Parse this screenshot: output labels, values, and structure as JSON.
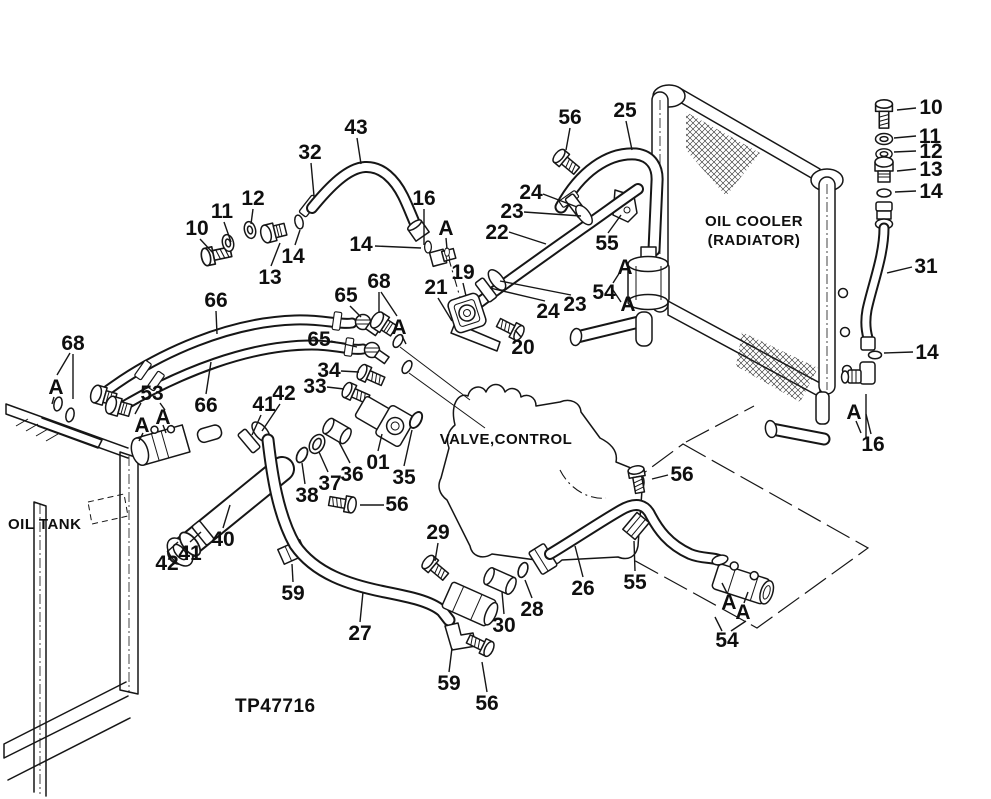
{
  "figure": {
    "drawing_number": "TP47716",
    "oil_cooler_label_line1": "OIL COOLER",
    "oil_cooler_label_line2": "(RADIATOR)",
    "valve_control_label": "VALVE,CONTROL",
    "oil_tank_label": "OIL TANK"
  },
  "callouts": [
    {
      "text": "10",
      "x": 197,
      "y": 228,
      "l": [
        200,
        239,
        213,
        253
      ]
    },
    {
      "text": "11",
      "x": 222,
      "y": 211,
      "l": [
        224,
        222,
        231,
        242
      ]
    },
    {
      "text": "12",
      "x": 253,
      "y": 198,
      "l": [
        253,
        209,
        251,
        224
      ]
    },
    {
      "text": "13",
      "x": 270,
      "y": 277,
      "l": [
        271,
        266,
        280,
        243
      ]
    },
    {
      "text": "14",
      "x": 293,
      "y": 256,
      "l": [
        295,
        245,
        300,
        230
      ]
    },
    {
      "text": "32",
      "x": 310,
      "y": 152,
      "l": [
        311,
        163,
        314,
        196
      ]
    },
    {
      "text": "43",
      "x": 356,
      "y": 127,
      "l": [
        357,
        138,
        361,
        164
      ]
    },
    {
      "text": "14",
      "x": 361,
      "y": 244,
      "l": [
        375,
        246,
        421,
        248
      ]
    },
    {
      "text": "16",
      "x": 424,
      "y": 198
    },
    {
      "text": "A",
      "x": 446,
      "y": 228,
      "l": [
        446,
        238,
        447,
        249
      ]
    },
    {
      "text": "56",
      "x": 570,
      "y": 117,
      "l": [
        570,
        128,
        566,
        150
      ]
    },
    {
      "text": "25",
      "x": 625,
      "y": 110,
      "l": [
        626,
        121,
        632,
        150
      ]
    },
    {
      "text": "24",
      "x": 531,
      "y": 192,
      "l": [
        543,
        194,
        577,
        207
      ]
    },
    {
      "text": "23",
      "x": 512,
      "y": 211,
      "l": [
        524,
        212,
        581,
        216
      ]
    },
    {
      "text": "22",
      "x": 497,
      "y": 232,
      "l": [
        509,
        232,
        546,
        244
      ]
    },
    {
      "text": "55",
      "x": 607,
      "y": 243,
      "l": [
        608,
        233,
        621,
        215
      ]
    },
    {
      "text": "54",
      "x": 604,
      "y": 292
    },
    {
      "text": "A",
      "x": 625,
      "y": 267
    },
    {
      "text": "A",
      "x": 628,
      "y": 304
    },
    {
      "text": "24",
      "x": 548,
      "y": 311,
      "l": [
        545,
        301,
        490,
        288
      ]
    },
    {
      "text": "23",
      "x": 575,
      "y": 304,
      "l": [
        571,
        295,
        500,
        281
      ]
    },
    {
      "text": "19",
      "x": 463,
      "y": 272,
      "l": [
        463,
        283,
        466,
        296
      ]
    },
    {
      "text": "21",
      "x": 436,
      "y": 287,
      "l": [
        438,
        298,
        452,
        321
      ]
    },
    {
      "text": "20",
      "x": 523,
      "y": 347,
      "l": [
        521,
        337,
        515,
        330
      ]
    },
    {
      "text": "68",
      "x": 379,
      "y": 281
    },
    {
      "text": "65",
      "x": 346,
      "y": 295,
      "l": [
        350,
        306,
        361,
        317
      ]
    },
    {
      "text": "65",
      "x": 319,
      "y": 339,
      "l": [
        331,
        341,
        357,
        347
      ]
    },
    {
      "text": "A",
      "x": 399,
      "y": 327,
      "l": [
        402,
        336,
        406,
        344
      ]
    },
    {
      "text": "34",
      "x": 329,
      "y": 370,
      "l": [
        341,
        371,
        359,
        372
      ]
    },
    {
      "text": "33",
      "x": 315,
      "y": 386,
      "l": [
        327,
        387,
        344,
        389
      ]
    },
    {
      "text": "66",
      "x": 216,
      "y": 300,
      "l": [
        216,
        311,
        217,
        334
      ]
    },
    {
      "text": "66",
      "x": 206,
      "y": 405,
      "l": [
        206,
        394,
        211,
        362
      ]
    },
    {
      "text": "68",
      "x": 73,
      "y": 343
    },
    {
      "text": "A",
      "x": 56,
      "y": 387,
      "l": [
        54,
        397,
        52,
        404
      ]
    },
    {
      "text": "53",
      "x": 152,
      "y": 393
    },
    {
      "text": "A",
      "x": 142,
      "y": 425,
      "l": [
        143,
        433,
        139,
        441
      ]
    },
    {
      "text": "A",
      "x": 163,
      "y": 417,
      "l": [
        163,
        425,
        166,
        433
      ]
    },
    {
      "text": "42",
      "x": 284,
      "y": 393,
      "l": [
        280,
        404,
        262,
        431
      ]
    },
    {
      "text": "41",
      "x": 264,
      "y": 404,
      "l": [
        261,
        415,
        252,
        435
      ]
    },
    {
      "text": "38",
      "x": 307,
      "y": 495,
      "l": [
        305,
        484,
        302,
        463
      ]
    },
    {
      "text": "37",
      "x": 330,
      "y": 483,
      "l": [
        328,
        472,
        319,
        452
      ]
    },
    {
      "text": "36",
      "x": 352,
      "y": 474,
      "l": [
        350,
        463,
        339,
        442
      ]
    },
    {
      "text": "01",
      "x": 378,
      "y": 462,
      "l": [
        378,
        451,
        382,
        434
      ]
    },
    {
      "text": "35",
      "x": 404,
      "y": 477,
      "l": [
        404,
        466,
        412,
        430
      ]
    },
    {
      "text": "56",
      "x": 397,
      "y": 504,
      "l": [
        384,
        505,
        360,
        505
      ]
    },
    {
      "text": "29",
      "x": 438,
      "y": 532,
      "l": [
        438,
        543,
        435,
        561
      ]
    },
    {
      "text": "40",
      "x": 223,
      "y": 539,
      "l": [
        223,
        528,
        230,
        505
      ]
    },
    {
      "text": "41",
      "x": 190,
      "y": 553,
      "l": [
        190,
        542,
        201,
        532
      ]
    },
    {
      "text": "42",
      "x": 167,
      "y": 563,
      "l": [
        167,
        552,
        178,
        542
      ]
    },
    {
      "text": "59",
      "x": 293,
      "y": 593,
      "l": [
        293,
        582,
        292,
        564
      ]
    },
    {
      "text": "27",
      "x": 360,
      "y": 633,
      "l": [
        360,
        622,
        363,
        592
      ]
    },
    {
      "text": "59",
      "x": 449,
      "y": 683,
      "l": [
        449,
        672,
        452,
        648
      ]
    },
    {
      "text": "56",
      "x": 487,
      "y": 703,
      "l": [
        487,
        692,
        482,
        662
      ]
    },
    {
      "text": "30",
      "x": 504,
      "y": 625,
      "l": [
        504,
        614,
        502,
        592
      ]
    },
    {
      "text": "28",
      "x": 532,
      "y": 609,
      "l": [
        532,
        598,
        525,
        580
      ]
    },
    {
      "text": "26",
      "x": 583,
      "y": 588,
      "l": [
        583,
        577,
        575,
        546
      ]
    },
    {
      "text": "55",
      "x": 635,
      "y": 582,
      "l": [
        635,
        571,
        634,
        541
      ]
    },
    {
      "text": "56",
      "x": 682,
      "y": 474,
      "l": [
        668,
        475,
        652,
        479
      ]
    },
    {
      "text": "A",
      "x": 729,
      "y": 602,
      "l": [
        727,
        593,
        722,
        583
      ]
    },
    {
      "text": "A",
      "x": 743,
      "y": 612,
      "l": [
        744,
        603,
        748,
        592
      ]
    },
    {
      "text": "54",
      "x": 727,
      "y": 640
    },
    {
      "text": "10",
      "x": 931,
      "y": 107,
      "l": [
        916,
        108,
        897,
        110
      ]
    },
    {
      "text": "11",
      "x": 930,
      "y": 136,
      "l": [
        916,
        136,
        894,
        138
      ]
    },
    {
      "text": "12",
      "x": 931,
      "y": 151,
      "l": [
        916,
        151,
        894,
        152
      ]
    },
    {
      "text": "13",
      "x": 931,
      "y": 169,
      "l": [
        916,
        169,
        897,
        171
      ]
    },
    {
      "text": "14",
      "x": 931,
      "y": 191,
      "l": [
        916,
        191,
        895,
        192
      ]
    },
    {
      "text": "31",
      "x": 926,
      "y": 266,
      "l": [
        912,
        267,
        887,
        273
      ]
    },
    {
      "text": "14",
      "x": 927,
      "y": 352,
      "l": [
        913,
        352,
        884,
        353
      ]
    },
    {
      "text": "A",
      "x": 854,
      "y": 412
    },
    {
      "text": "16",
      "x": 873,
      "y": 444,
      "l": [
        871,
        434,
        866,
        414
      ]
    }
  ]
}
